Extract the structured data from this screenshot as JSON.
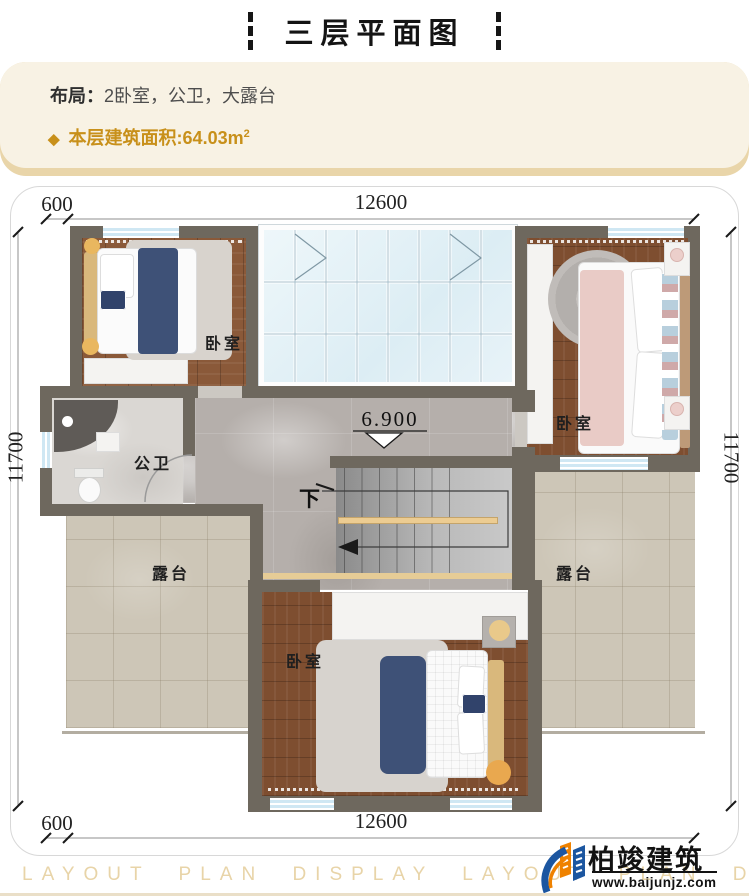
{
  "header": {
    "title": "三层平面图"
  },
  "info_card": {
    "layout_label": "布局：",
    "layout_value": "2卧室，公卫，大露台",
    "diamond_icon": "◆",
    "area_label": "本层建筑面积:",
    "area_value": "64.03m",
    "area_unit_sup": "2",
    "accent_color": "#c8901a"
  },
  "plan": {
    "dimensions": {
      "top_offset": "600",
      "top_width": "12600",
      "bottom_offset": "600",
      "bottom_width": "12600",
      "left_height": "11700",
      "right_height": "11700"
    },
    "rooms": {
      "bedroom_top_left": "卧室",
      "bedroom_top_right": "卧室",
      "bedroom_bottom": "卧室",
      "bathroom": "公卫",
      "terrace_left": "露台",
      "terrace_right": "露台"
    },
    "markers": {
      "elevation": "6.900",
      "stairs_down": "下"
    },
    "wall_color": "#6e685e"
  },
  "footer": {
    "watermark_text": "LAYOUT PLAN DISPLAY LAYOUT PLAN DISPLAY",
    "brand_name": "柏竣建筑",
    "brand_url": "www.baijunjz.com"
  }
}
